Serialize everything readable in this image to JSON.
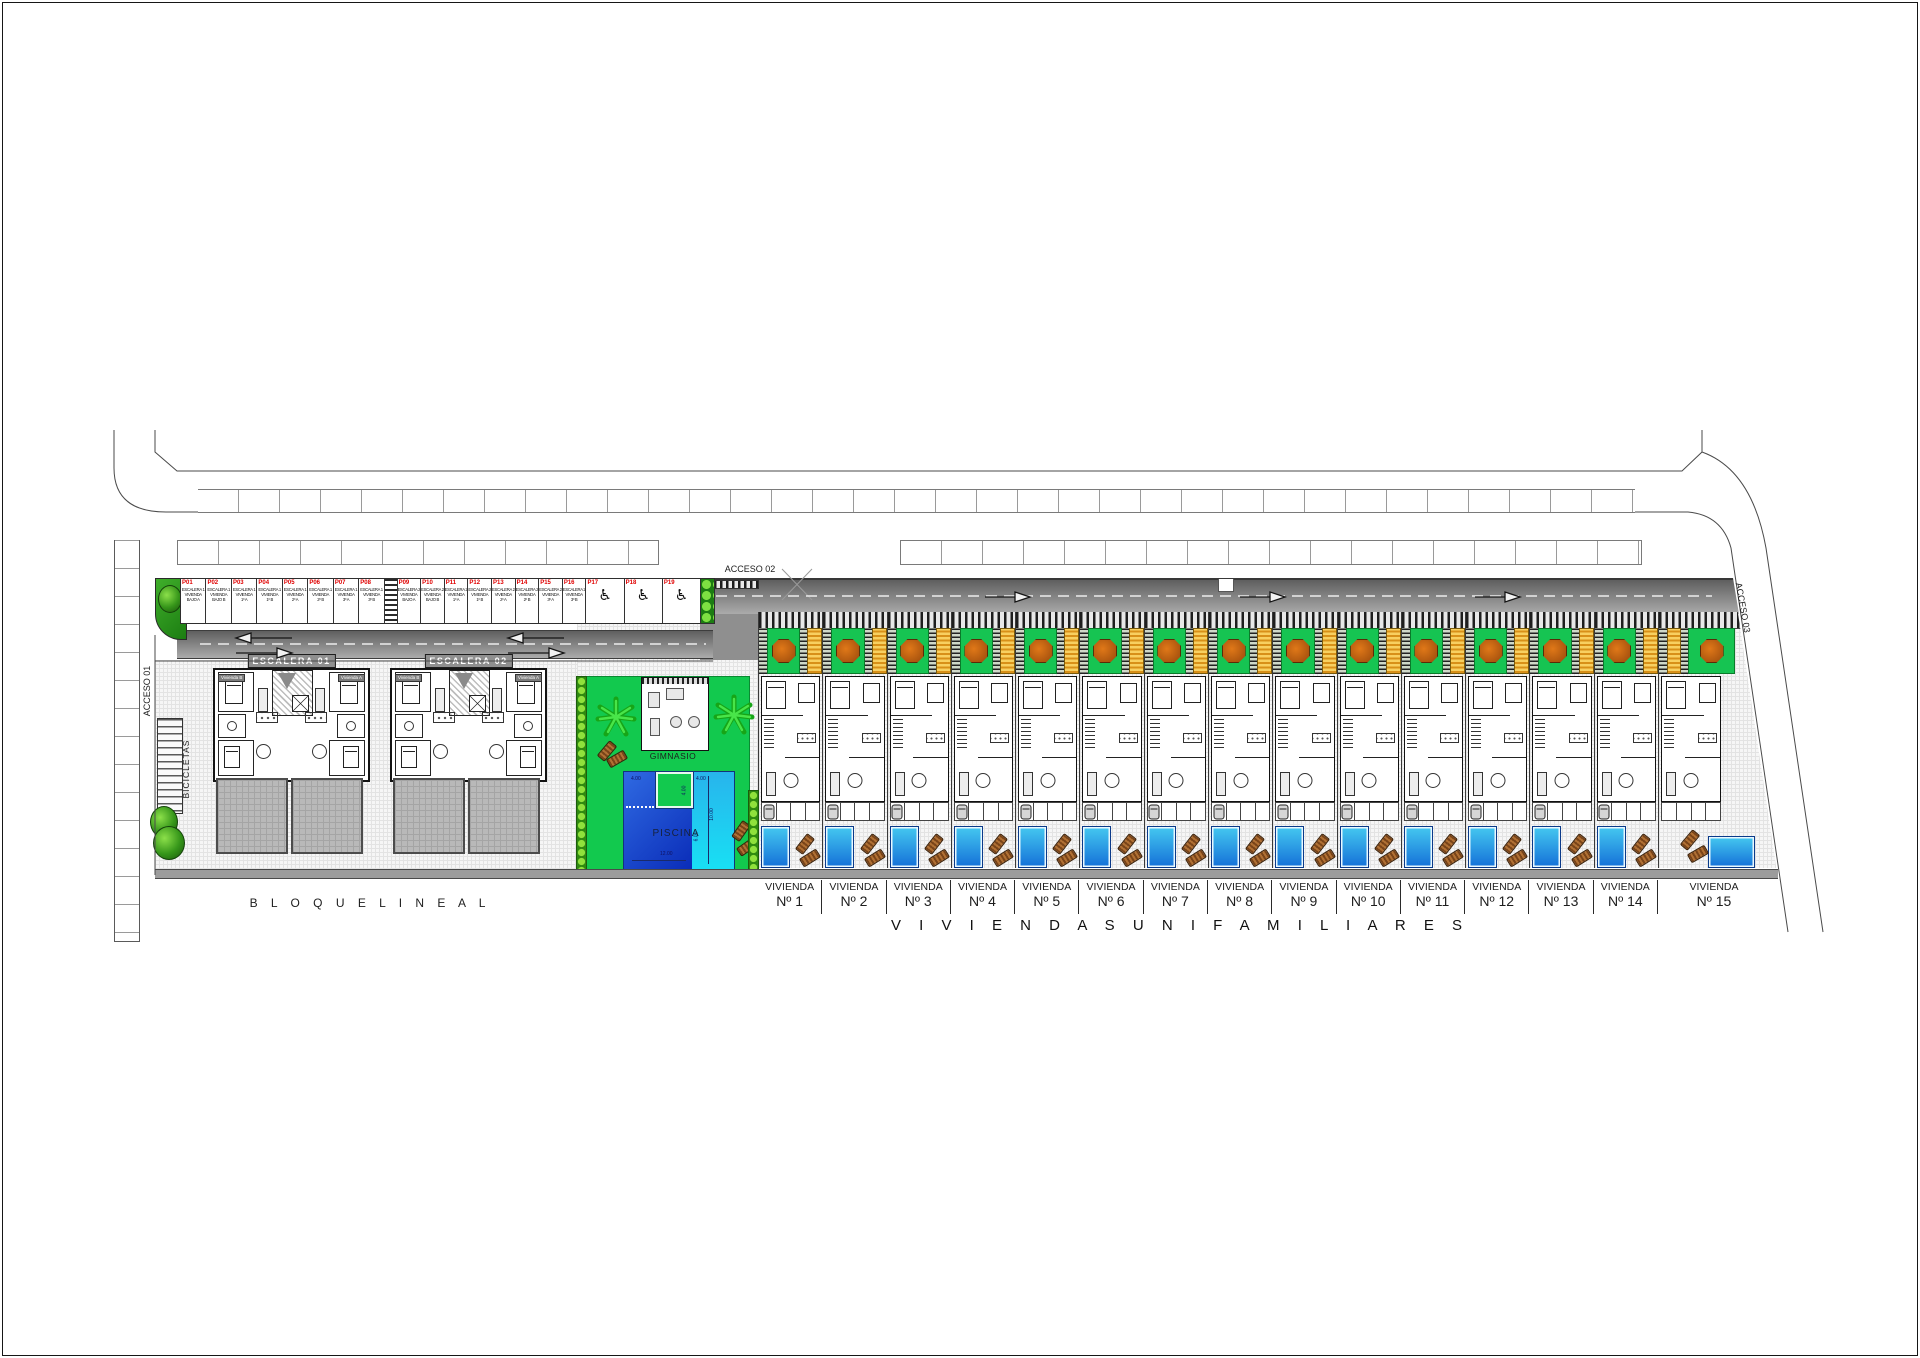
{
  "plan": {
    "accesses": {
      "a1": "ACCESO 01",
      "a2": "ACCESO 02",
      "a3": "ACCESO 03"
    },
    "bicycles_label": "BICICLETAS",
    "block_label": "B L O Q U E   L I N E A L",
    "villas_title": "V I V I E N D A S   U N I F A M I L I A R E S",
    "gym_label": "GIMNASIO",
    "wheelchair": "♿",
    "villa_word": "VIVIENDA",
    "pool": {
      "label": "PISCINA",
      "dims": {
        "w_left": "4.00",
        "w_right": "4.00",
        "notch_depth": "4.00",
        "len_right": "10.00",
        "len_mid": "6.00",
        "len_bottom": "12.00"
      }
    },
    "stairs": [
      {
        "label": "ESCALERA 01"
      },
      {
        "label": "ESCALERA 02"
      }
    ],
    "unit_tags": {
      "left": "Vivienda B",
      "right": "Vivienda A"
    },
    "parking": {
      "group1": [
        {
          "p": "P01",
          "l1": "ESCALERA 1",
          "l2": "VIVIENDA",
          "l3": "BAJO A"
        },
        {
          "p": "P02",
          "l1": "ESCALERA 1",
          "l2": "VIVIENDA",
          "l3": "BAJO B"
        },
        {
          "p": "P03",
          "l1": "ESCALERA 1",
          "l2": "VIVIENDA",
          "l3": "1º A"
        },
        {
          "p": "P04",
          "l1": "ESCALERA 1",
          "l2": "VIVIENDA",
          "l3": "1º B"
        },
        {
          "p": "P05",
          "l1": "ESCALERA 1",
          "l2": "VIVIENDA",
          "l3": "2º A"
        },
        {
          "p": "P06",
          "l1": "ESCALERA 1",
          "l2": "VIVIENDA",
          "l3": "2º B"
        },
        {
          "p": "P07",
          "l1": "ESCALERA 1",
          "l2": "VIVIENDA",
          "l3": "3º A"
        },
        {
          "p": "P08",
          "l1": "ESCALERA 1",
          "l2": "VIVIENDA",
          "l3": "3º B"
        }
      ],
      "group2": [
        {
          "p": "P09",
          "l1": "ESCALERA 2",
          "l2": "VIVIENDA",
          "l3": "BAJO A"
        },
        {
          "p": "P10",
          "l1": "ESCALERA 2",
          "l2": "VIVIENDA",
          "l3": "BAJO B"
        },
        {
          "p": "P11",
          "l1": "ESCALERA 2",
          "l2": "VIVIENDA",
          "l3": "1º A"
        },
        {
          "p": "P12",
          "l1": "ESCALERA 2",
          "l2": "VIVIENDA",
          "l3": "1º B"
        },
        {
          "p": "P13",
          "l1": "ESCALERA 2",
          "l2": "VIVIENDA",
          "l3": "2º A"
        },
        {
          "p": "P14",
          "l1": "ESCALERA 2",
          "l2": "VIVIENDA",
          "l3": "2º B"
        },
        {
          "p": "P15",
          "l1": "ESCALERA 2",
          "l2": "VIVIENDA",
          "l3": "3º A"
        },
        {
          "p": "P16",
          "l1": "ESCALERA 2",
          "l2": "VIVIENDA",
          "l3": "3º B"
        }
      ],
      "handicap": [
        {
          "p": "P17"
        },
        {
          "p": "P18"
        },
        {
          "p": "P19"
        }
      ]
    },
    "villas": [
      {
        "n": "Nº 1"
      },
      {
        "n": "Nº 2"
      },
      {
        "n": "Nº 3"
      },
      {
        "n": "Nº 4"
      },
      {
        "n": "Nº 5"
      },
      {
        "n": "Nº 6"
      },
      {
        "n": "Nº 7"
      },
      {
        "n": "Nº 8"
      },
      {
        "n": "Nº 9"
      },
      {
        "n": "Nº 10"
      },
      {
        "n": "Nº 11"
      },
      {
        "n": "Nº 12"
      },
      {
        "n": "Nº 13"
      },
      {
        "n": "Nº 14"
      }
    ],
    "villa15": {
      "n": "Nº 15"
    },
    "colors": {
      "garden_green": "#16c452",
      "amenity_green": "#12c94e",
      "pool_dark_blue": "#0a2cb8",
      "pool_light_blue": "#18e0f4",
      "pergola_yellow": "#e8a820",
      "tree_orange": "#c9661d",
      "road_gray": "#8a8a8a",
      "parking_label_red": "#e00000"
    }
  }
}
